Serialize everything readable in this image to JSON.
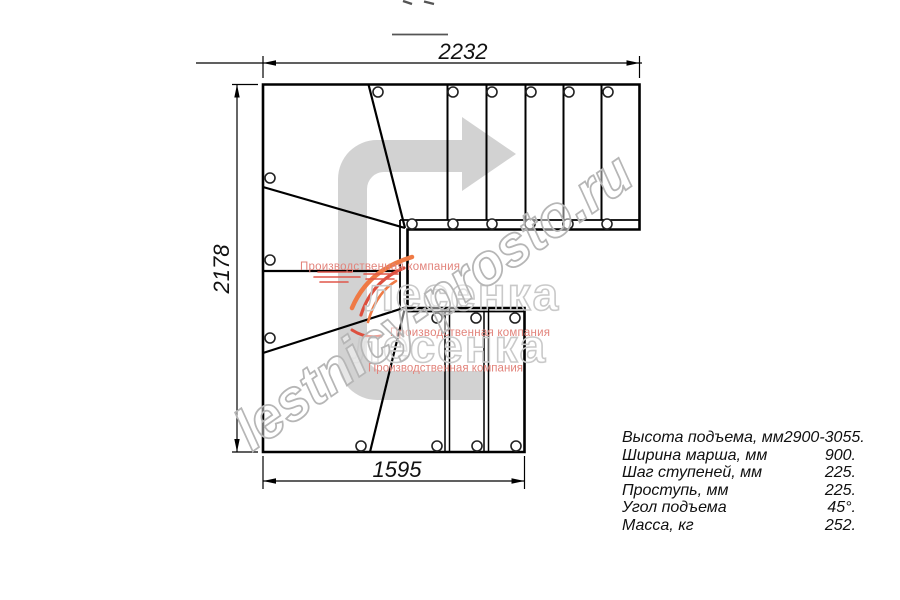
{
  "drawing": {
    "dim_top": "2232",
    "dim_left": "2178",
    "dim_bottom": "1595"
  },
  "specs": {
    "rows": [
      {
        "label": "Высота подъема, мм",
        "value": "2900-3055."
      },
      {
        "label": "Ширина марша, мм",
        "value": "900."
      },
      {
        "label": "Шаг ступеней, мм",
        "value": "225."
      },
      {
        "label": "Проступь, мм",
        "value": "225."
      },
      {
        "label": "Угол подъема",
        "value": "45°."
      },
      {
        "label": "Масса, кг",
        "value": "252."
      }
    ]
  },
  "watermark": {
    "site": "lestnicy-prosto.ru",
    "logo_title": "лесенка",
    "logo_subtitle": "Производственная компания"
  },
  "colors": {
    "line": "#000000",
    "direction_arrow": "#d2d2d2",
    "site_watermark_gray": "#b6b6b6",
    "logo_outline_gray": "#c9c9c9",
    "logo_red": "#e2837b",
    "flame_orange": "#ef7a45",
    "flame_red": "#dd4f3e"
  }
}
